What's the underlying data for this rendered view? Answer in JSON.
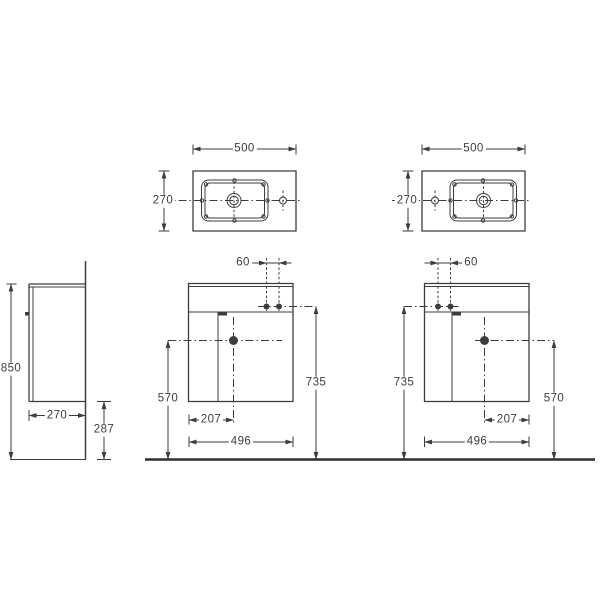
{
  "colors": {
    "line": "#3d3d3d",
    "background": "#ffffff",
    "floor_line": "#2e2e2e"
  },
  "views": {
    "plan_left": {
      "width": "500",
      "depth": "270"
    },
    "plan_right": {
      "width": "500",
      "depth": "270"
    },
    "side": {
      "overall_height": "850",
      "depth": "270",
      "floor_clearance": "287"
    },
    "front_left": {
      "tap_hole_spacing": "60",
      "tap_hole_height": "735",
      "drain_height": "570",
      "drain_offset": "207",
      "cabinet_width": "496"
    },
    "front_right": {
      "tap_hole_spacing": "60",
      "tap_hole_height": "735",
      "drain_height": "570",
      "drain_offset": "207",
      "cabinet_width": "496"
    }
  }
}
